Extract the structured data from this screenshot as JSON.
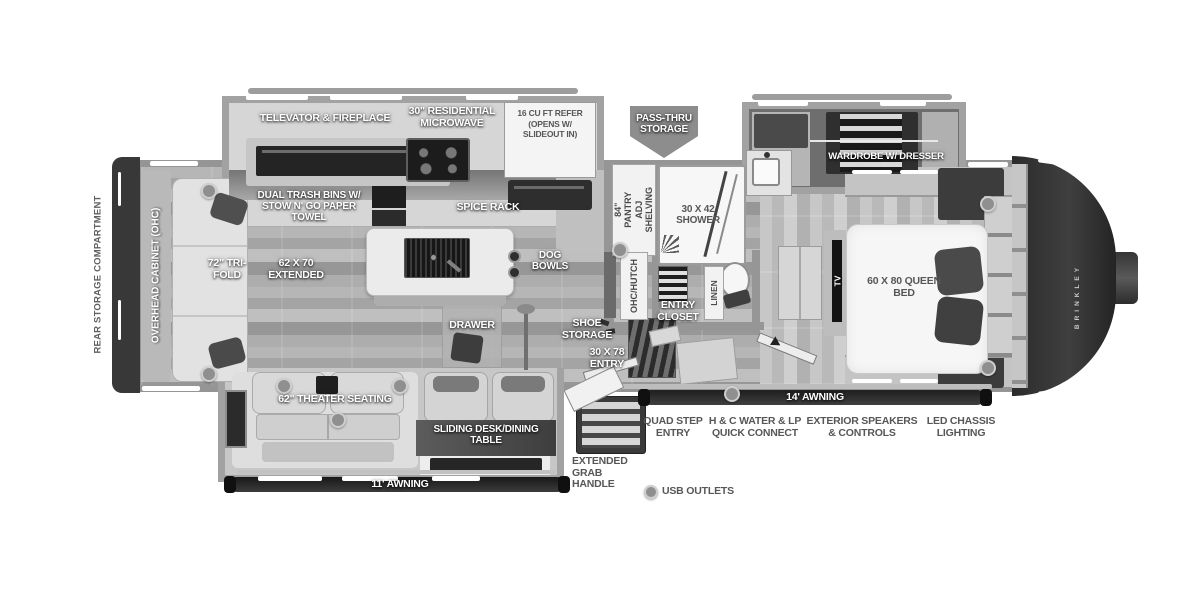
{
  "title": "Fifth Wheel RV Floorplan",
  "labels": {
    "rear_storage": "REAR STORAGE COMPARTMENT",
    "ohc": "OVERHEAD CABINET (OHC)",
    "trifold": "72\" TRI-FOLD",
    "sofa_ext": "62 x 70 EXTENDED",
    "televator": "TELEVATOR & FIREPLACE",
    "microwave": "30\" RESIDENTIAL MICROWAVE",
    "refer": "16 CU FT REFER (OPENS w/ SLIDEOUT IN)",
    "trash": "DUAL TRASH BINS w/ STOW N' GO PAPER TOWEL",
    "spice": "SPICE RACK",
    "dog_bowls": "DOG BOWLS",
    "drawer": "DRAWER",
    "theater": "62\" THEATER SEATING",
    "desk": "SLIDING DESK/DINING TABLE",
    "awning11": "11' AWNING",
    "awning14": "14' AWNING",
    "pantry": "84\" PANTRY ADJ SHELVING",
    "hutch": "OHC/HUTCH",
    "shoe": "SHOE STORAGE",
    "entry": "30 X 78 ENTRY",
    "closet": "ENTRY CLOSET",
    "shower": "30 x 42 SHOWER",
    "linen": "LINEN",
    "passthru": "PASS-THRU STORAGE",
    "wardrobe": "WARDROBE w/ DRESSER",
    "bed": "60 x 80 QUEEN BED",
    "tv": "TV",
    "brand": "BRINKLEY",
    "quad": "QUAD STEP ENTRY",
    "water": "H & C WATER & LP QUICK CONNECT",
    "speakers": "EXTERIOR SPEAKERS & CONTROLS",
    "chassis": "LED CHASSIS LIGHTING",
    "grab": "EXTENDED GRAB HANDLE",
    "usb": "USB OUTLETS"
  },
  "icons": {
    "usb_outlet": "usb-outlet-dot",
    "pass_thru_arrow": "down-pointer-pentagon"
  },
  "colors": {
    "wall": "#969696",
    "slideout_wall": "#a2a2a2",
    "dark_fixture": "#2e2e2e",
    "front_cap": "#333333",
    "floor_mid": "#ababab",
    "label_white": "#ffffff",
    "label_dark": "#575757"
  }
}
